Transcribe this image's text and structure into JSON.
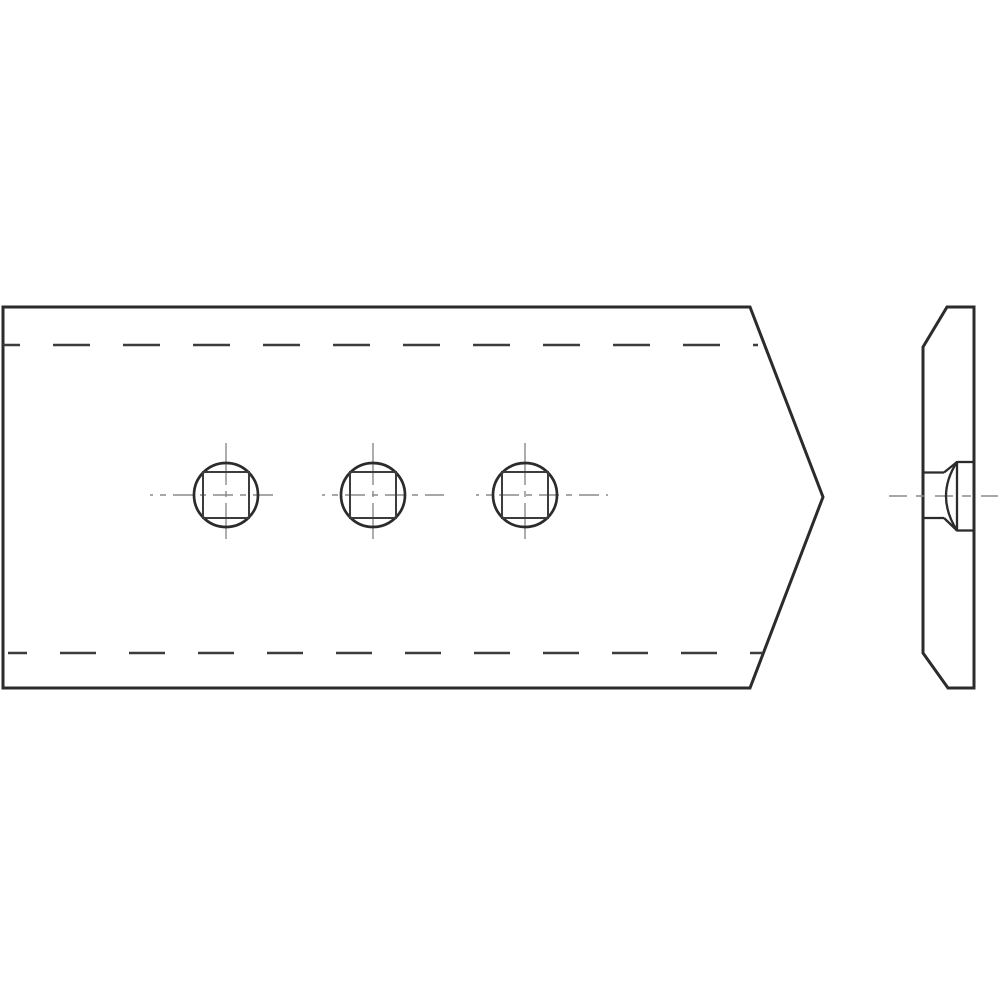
{
  "canvas": {
    "width": 1000,
    "height": 1000,
    "background": "#ffffff"
  },
  "colors": {
    "outline": "#2b2b2b",
    "hidden_edge": "#3c3c3c",
    "centerline": "#8a8a8a",
    "fill": "#ffffff"
  },
  "stroke_widths": {
    "outline": 3,
    "hidden_edge": 2.4,
    "centerline": 1.4,
    "hole_circle": 2.7,
    "hole_square": 2,
    "detail": 2.3
  },
  "front_view": {
    "outline_points": "3,307 750,307 823,497 750,688 3,688",
    "hidden_edge_lines": [
      {
        "x1": 3,
        "y1": 345,
        "x2": 758,
        "y2": 345,
        "dash": "37 33",
        "offset": 20
      },
      {
        "x1": 8,
        "y1": 653,
        "x2": 763,
        "y2": 653,
        "dash": "36 33",
        "offset": 17
      }
    ],
    "holes": [
      {
        "cx": 226,
        "cy": 495,
        "r": 32,
        "square_side": 46,
        "h_span": [
          150,
          277
        ],
        "v_span": [
          443,
          539
        ]
      },
      {
        "cx": 373,
        "cy": 495,
        "r": 32,
        "square_side": 46,
        "h_span": [
          322,
          444
        ],
        "v_span": [
          443,
          539
        ]
      },
      {
        "cx": 525,
        "cy": 495,
        "r": 32,
        "square_side": 46,
        "h_span": [
          476,
          608
        ],
        "v_span": [
          443,
          539
        ]
      }
    ],
    "centerline_dash_h": "20 7 6 7",
    "centerline_dash_h_offset": 17,
    "centerline_dash_v": "42 6 6 6",
    "centerline_dash_v_offset": 0
  },
  "side_view": {
    "outline_points": "947,307 974,307 974,688 948,688 923,653 923,347",
    "centerline": {
      "x1": 889,
      "y1": 496,
      "x2": 998,
      "y2": 496,
      "dash": "18 9 9 10",
      "offset": 0
    },
    "bolt_detail_paths": [
      "M 923 472.5 H 944",
      "M 923 518 H 944",
      "M 944 472.5 L 957 462",
      "M 944 518 L 957 530.5",
      "M 957 461 V 531.5",
      "M 957 462 H 973",
      "M 957 530.5 H 973",
      "M 957 462 Q 935 496 957 530.5"
    ]
  }
}
